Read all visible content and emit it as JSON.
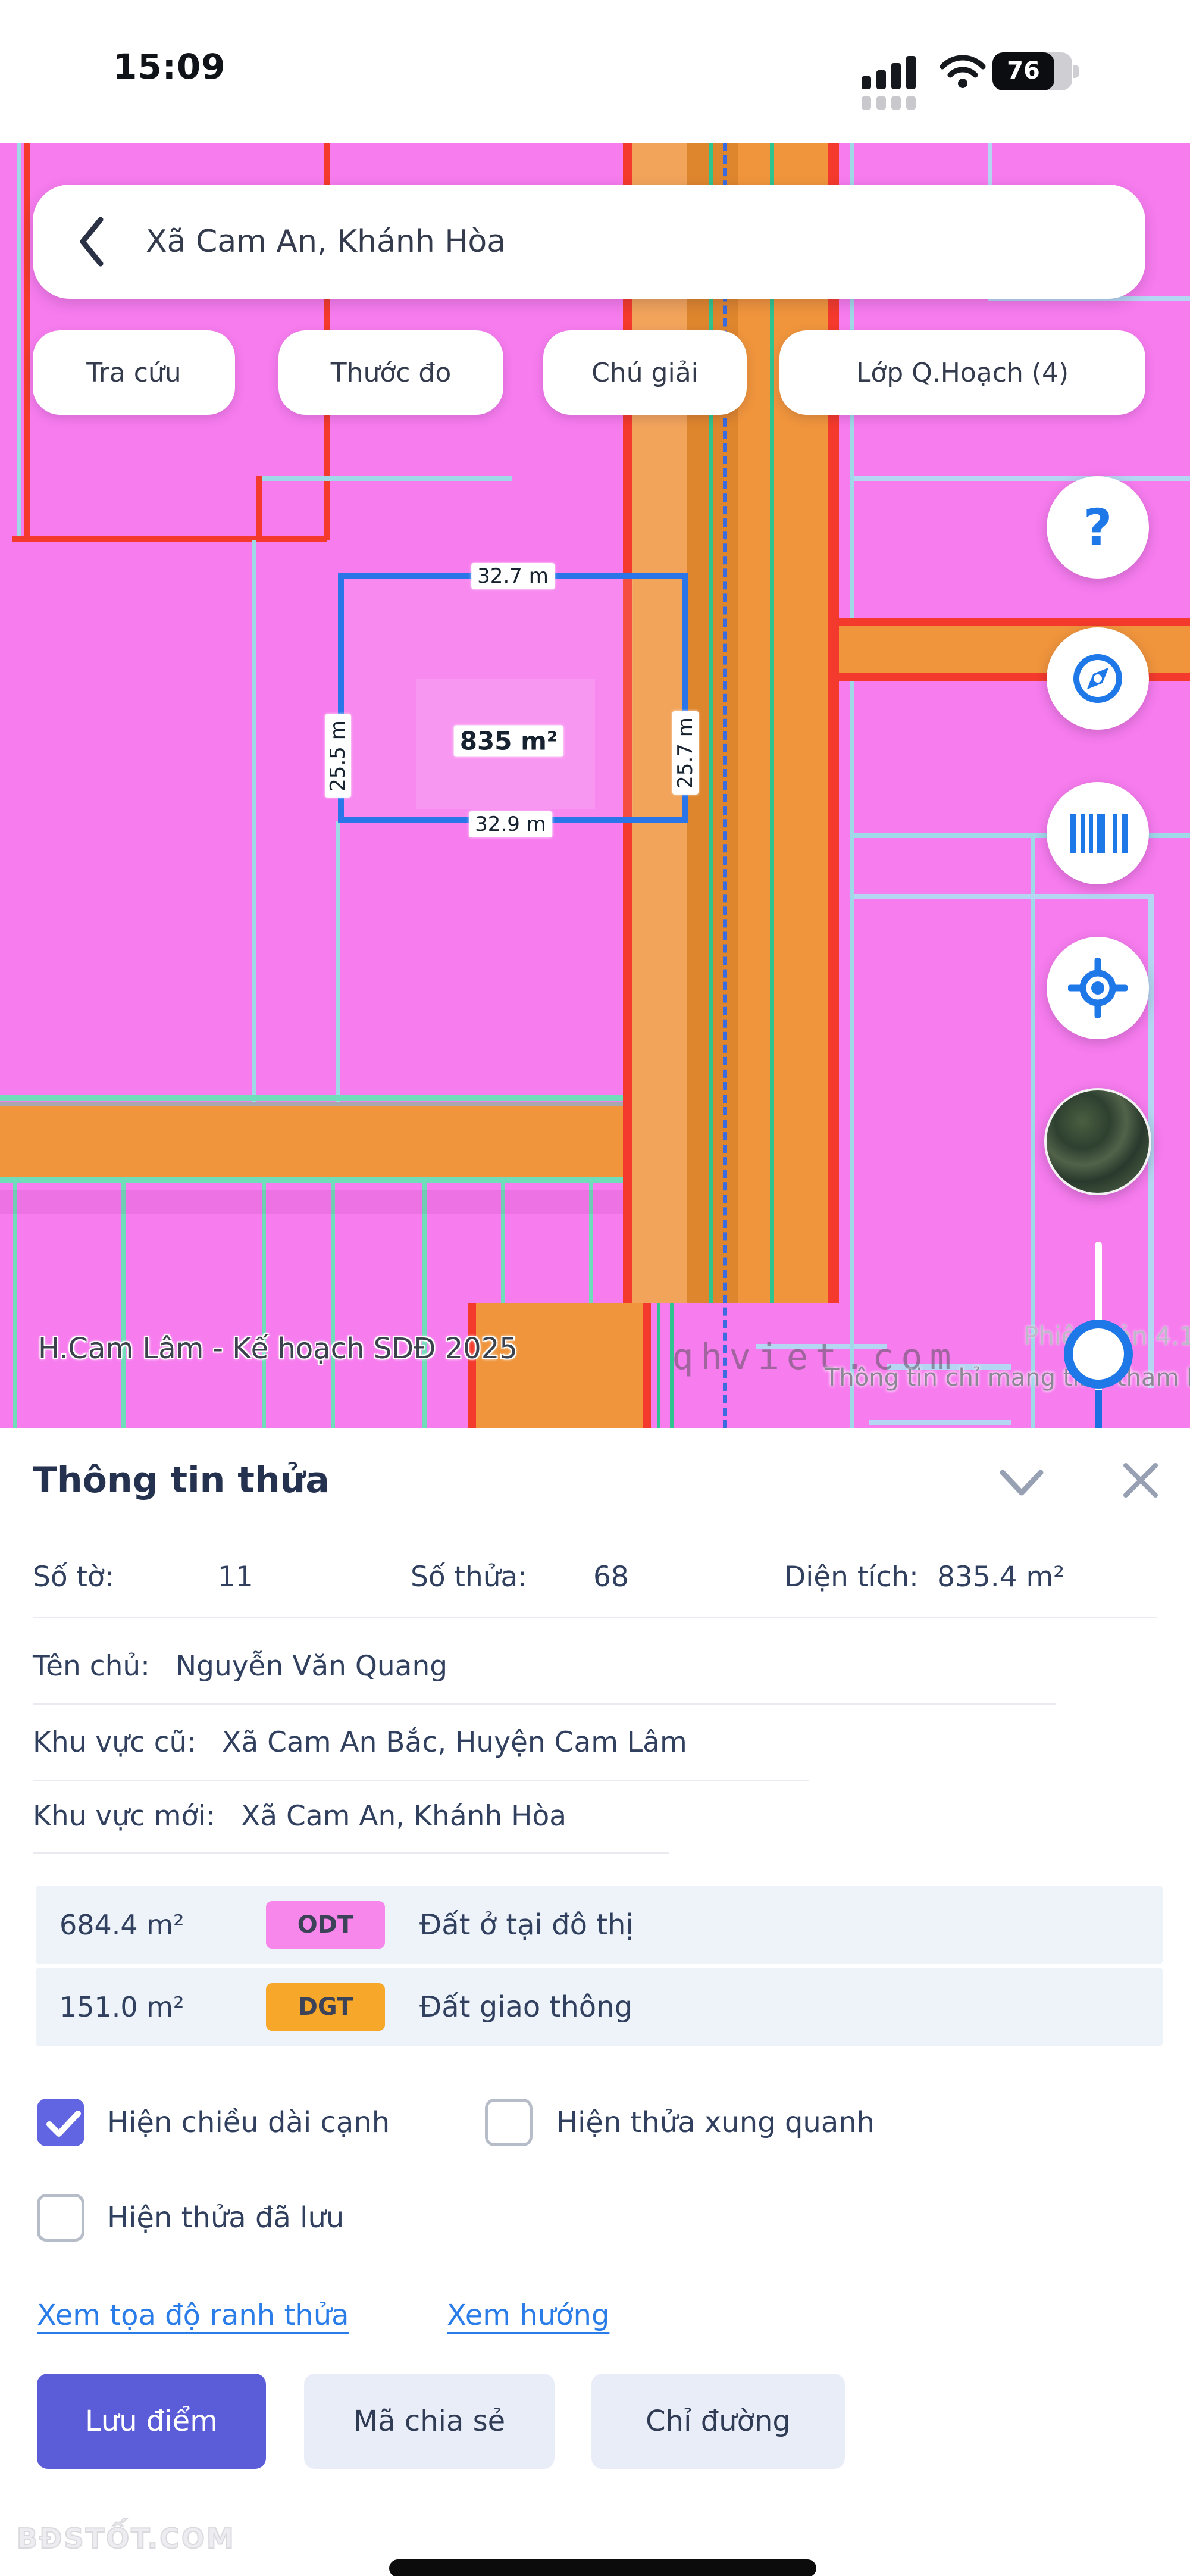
{
  "status_bar": {
    "time": "15:09",
    "battery_percent": "76"
  },
  "map": {
    "search": {
      "query": "Xã Cam An, Khánh Hòa"
    },
    "chips": [
      {
        "label": "Tra cứu"
      },
      {
        "label": "Thước đo"
      },
      {
        "label": "Chú giải"
      },
      {
        "label": "Lớp Q.Hoạch (4)"
      }
    ],
    "fabs": [
      {
        "name": "help",
        "glyph": "?"
      },
      {
        "name": "compass"
      },
      {
        "name": "barcode"
      },
      {
        "name": "locate"
      },
      {
        "name": "satellite-preview"
      }
    ],
    "parcel": {
      "edge_top": "32.7 m",
      "edge_left": "25.5 m",
      "edge_right": "25.7 m",
      "edge_bottom": "32.9 m",
      "area": "835 m²"
    },
    "labels": {
      "layer": "H.Cam Lâm - Kế hoạch SDĐ 2025",
      "disclaimer": "Thông tin chỉ mang tính tham khảo",
      "version": "Phiên bản 4.1",
      "watermark": "qhviet.com"
    },
    "colors": {
      "base_pink": "#f77cee",
      "road_orange": "#f0953c",
      "road_dark_orange": "#de862e",
      "boundary_red": "#f43a2c",
      "boundary_mint": "#6fdcba",
      "boundary_pale_blue": "#b5d6f2",
      "plan_dashed_blue": "#3a6ce0",
      "parcel_outline_blue": "#2a76e8"
    }
  },
  "panel": {
    "title": "Thông tin thửa",
    "fields": {
      "so_to_label": "Số tờ:",
      "so_to": "11",
      "so_thua_label": "Số thửa:",
      "so_thua": "68",
      "dien_tich_label": "Diện tích:",
      "dien_tich": "835.4 m²",
      "ten_chu_label": "Tên chủ:",
      "ten_chu": "Nguyễn Văn Quang",
      "khu_vuc_cu_label": "Khu vực cũ:",
      "khu_vuc_cu": "Xã Cam An Bắc, Huyện Cam Lâm",
      "khu_vuc_moi_label": "Khu vực mới:",
      "khu_vuc_moi": "Xã Cam An, Khánh Hòa"
    },
    "land_uses": [
      {
        "area": "684.4 m²",
        "code": "ODT",
        "name": "Đất ở tại đô thị",
        "color": "#f787ea"
      },
      {
        "area": "151.0 m²",
        "code": "DGT",
        "name": "Đất giao thông",
        "color": "#f7a82b"
      }
    ],
    "checkboxes": [
      {
        "label": "Hiện chiều dài cạnh",
        "checked": true
      },
      {
        "label": "Hiện thửa xung quanh",
        "checked": false
      },
      {
        "label": "Hiện thửa đã lưu",
        "checked": false
      }
    ],
    "links": [
      {
        "label": "Xem tọa độ ranh thửa"
      },
      {
        "label": "Xem hướng"
      }
    ],
    "buttons": [
      {
        "label": "Lưu điểm",
        "primary": true
      },
      {
        "label": "Mã chia sẻ"
      },
      {
        "label": "Chỉ đường"
      }
    ]
  },
  "footer": {
    "watermark": "BĐSTỐT.COM"
  }
}
